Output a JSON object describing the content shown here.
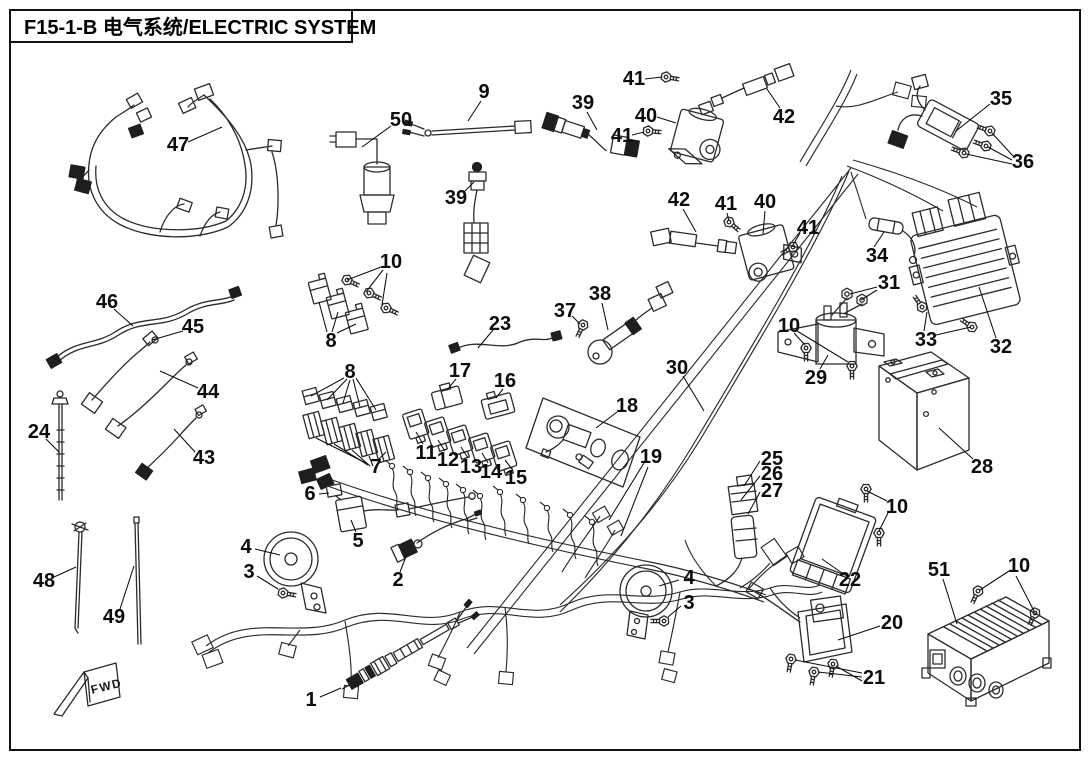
{
  "doc": {
    "title": "F15-1-B 电气系统/ELECTRIC SYSTEM",
    "fwd": "FWD"
  },
  "style": {
    "line_color": "#2b2b2b",
    "label_color": "#0d0d0d",
    "background": "#ffffff"
  },
  "callouts": [
    {
      "n": "47",
      "x": 178,
      "y": 145,
      "l": [
        [
          188,
          142,
          222,
          127
        ]
      ]
    },
    {
      "n": "50",
      "x": 401,
      "y": 120,
      "l": [
        [
          391,
          126,
          362,
          147
        ]
      ]
    },
    {
      "n": "9",
      "x": 484,
      "y": 92,
      "l": [
        [
          481,
          101,
          468,
          121
        ]
      ]
    },
    {
      "n": "39",
      "x": 583,
      "y": 103,
      "l": [
        [
          587,
          112,
          597,
          130
        ]
      ]
    },
    {
      "n": "41",
      "x": 634,
      "y": 79,
      "l": [
        [
          645,
          79,
          662,
          77
        ]
      ]
    },
    {
      "n": "40",
      "x": 646,
      "y": 116,
      "l": [
        [
          657,
          117,
          676,
          123
        ]
      ]
    },
    {
      "n": "41",
      "x": 622,
      "y": 136,
      "l": [
        [
          632,
          135,
          644,
          132
        ]
      ]
    },
    {
      "n": "42",
      "x": 784,
      "y": 117,
      "l": [
        [
          780,
          108,
          767,
          89
        ]
      ]
    },
    {
      "n": "35",
      "x": 1001,
      "y": 99,
      "l": [
        [
          990,
          104,
          956,
          131
        ]
      ]
    },
    {
      "n": "36",
      "x": 1023,
      "y": 162,
      "l": [
        [
          1013,
          156,
          992,
          133
        ],
        [
          1012,
          160,
          988,
          147
        ],
        [
          1012,
          164,
          966,
          154
        ]
      ]
    },
    {
      "n": "39",
      "x": 456,
      "y": 198,
      "l": [
        [
          464,
          192,
          474,
          182
        ]
      ]
    },
    {
      "n": "10",
      "x": 391,
      "y": 262,
      "l": [
        [
          381,
          267,
          347,
          280
        ],
        [
          383,
          270,
          366,
          292
        ],
        [
          387,
          273,
          382,
          305
        ]
      ]
    },
    {
      "n": "8",
      "x": 331,
      "y": 341,
      "l": [
        [
          327,
          332,
          319,
          302
        ],
        [
          332,
          332,
          338,
          312
        ],
        [
          337,
          333,
          356,
          324
        ]
      ]
    },
    {
      "n": "23",
      "x": 500,
      "y": 324,
      "l": [
        [
          493,
          330,
          478,
          348
        ]
      ]
    },
    {
      "n": "17",
      "x": 460,
      "y": 371,
      "l": [
        [
          456,
          379,
          447,
          390
        ]
      ]
    },
    {
      "n": "16",
      "x": 505,
      "y": 381,
      "l": [
        [
          503,
          389,
          496,
          398
        ]
      ]
    },
    {
      "n": "37",
      "x": 565,
      "y": 311,
      "l": [
        [
          572,
          316,
          580,
          324
        ]
      ]
    },
    {
      "n": "38",
      "x": 600,
      "y": 294,
      "l": [
        [
          602,
          303,
          608,
          330
        ]
      ]
    },
    {
      "n": "30",
      "x": 677,
      "y": 368,
      "l": [
        [
          683,
          376,
          704,
          411
        ]
      ]
    },
    {
      "n": "8",
      "x": 350,
      "y": 372,
      "l": [
        [
          344,
          378,
          311,
          396
        ],
        [
          347,
          379,
          327,
          400
        ],
        [
          350,
          380,
          343,
          403
        ],
        [
          353,
          379,
          360,
          407
        ],
        [
          356,
          378,
          376,
          410
        ]
      ]
    },
    {
      "n": "7",
      "x": 376,
      "y": 467,
      "l": [
        [
          366,
          463,
          316,
          438
        ],
        [
          368,
          465,
          334,
          444
        ],
        [
          370,
          466,
          352,
          450
        ],
        [
          373,
          466,
          369,
          456
        ],
        [
          378,
          460,
          386,
          452
        ]
      ]
    },
    {
      "n": "11",
      "x": 426,
      "y": 453,
      "l": [
        [
          423,
          444,
          416,
          432
        ]
      ]
    },
    {
      "n": "12",
      "x": 448,
      "y": 460,
      "l": [
        [
          445,
          451,
          438,
          440
        ]
      ]
    },
    {
      "n": "13",
      "x": 471,
      "y": 467,
      "l": [
        [
          468,
          458,
          461,
          447
        ]
      ]
    },
    {
      "n": "14",
      "x": 491,
      "y": 472,
      "l": [
        [
          488,
          463,
          482,
          453
        ]
      ]
    },
    {
      "n": "15",
      "x": 516,
      "y": 478,
      "l": [
        [
          512,
          469,
          505,
          460
        ]
      ]
    },
    {
      "n": "18",
      "x": 627,
      "y": 406,
      "l": [
        [
          617,
          412,
          596,
          428
        ]
      ]
    },
    {
      "n": "19",
      "x": 651,
      "y": 457,
      "l": [
        [
          644,
          463,
          609,
          520
        ],
        [
          648,
          467,
          621,
          536
        ]
      ]
    },
    {
      "n": "25",
      "x": 772,
      "y": 459,
      "l": [
        [
          760,
          461,
          744,
          486
        ]
      ]
    },
    {
      "n": "26",
      "x": 772,
      "y": 474,
      "l": [
        [
          760,
          476,
          741,
          500
        ]
      ]
    },
    {
      "n": "27",
      "x": 772,
      "y": 491,
      "l": [
        [
          760,
          492,
          748,
          514
        ]
      ]
    },
    {
      "n": "10",
      "x": 897,
      "y": 507,
      "l": [
        [
          887,
          501,
          867,
          491
        ],
        [
          888,
          513,
          879,
          531
        ]
      ]
    },
    {
      "n": "22",
      "x": 850,
      "y": 580,
      "l": [
        [
          842,
          573,
          822,
          559
        ]
      ]
    },
    {
      "n": "20",
      "x": 892,
      "y": 623,
      "l": [
        [
          880,
          626,
          838,
          640
        ]
      ]
    },
    {
      "n": "21",
      "x": 874,
      "y": 678,
      "l": [
        [
          862,
          673,
          795,
          660
        ],
        [
          862,
          677,
          818,
          672
        ],
        [
          862,
          681,
          836,
          666
        ]
      ]
    },
    {
      "n": "51",
      "x": 939,
      "y": 570,
      "l": [
        [
          943,
          579,
          957,
          624
        ]
      ]
    },
    {
      "n": "10",
      "x": 1019,
      "y": 566,
      "l": [
        [
          1009,
          571,
          980,
          590
        ],
        [
          1016,
          576,
          1034,
          611
        ]
      ]
    },
    {
      "n": "28",
      "x": 982,
      "y": 467,
      "l": [
        [
          973,
          459,
          939,
          428
        ]
      ]
    },
    {
      "n": "31",
      "x": 889,
      "y": 283,
      "l": [
        [
          877,
          287,
          850,
          294
        ],
        [
          877,
          290,
          861,
          300
        ]
      ]
    },
    {
      "n": "34",
      "x": 877,
      "y": 256,
      "l": [
        [
          874,
          247,
          884,
          232
        ]
      ]
    },
    {
      "n": "33",
      "x": 926,
      "y": 340,
      "l": [
        [
          924,
          331,
          927,
          312
        ],
        [
          936,
          335,
          971,
          327
        ]
      ]
    },
    {
      "n": "32",
      "x": 1001,
      "y": 347,
      "l": [
        [
          996,
          338,
          979,
          287
        ]
      ]
    },
    {
      "n": "29",
      "x": 816,
      "y": 378,
      "l": [
        [
          820,
          369,
          828,
          355
        ]
      ]
    },
    {
      "n": "10",
      "x": 789,
      "y": 326,
      "l": [
        [
          794,
          333,
          805,
          345
        ],
        [
          797,
          331,
          848,
          362
        ]
      ]
    },
    {
      "n": "42",
      "x": 679,
      "y": 200,
      "l": [
        [
          683,
          209,
          696,
          232
        ]
      ]
    },
    {
      "n": "41",
      "x": 726,
      "y": 204,
      "l": [
        [
          727,
          213,
          729,
          221
        ]
      ]
    },
    {
      "n": "40",
      "x": 765,
      "y": 202,
      "l": [
        [
          765,
          211,
          763,
          234
        ]
      ]
    },
    {
      "n": "41",
      "x": 808,
      "y": 228,
      "l": [
        [
          800,
          233,
          793,
          245
        ]
      ]
    },
    {
      "n": "46",
      "x": 107,
      "y": 302,
      "l": [
        [
          114,
          309,
          133,
          326
        ]
      ]
    },
    {
      "n": "45",
      "x": 193,
      "y": 327,
      "l": [
        [
          183,
          331,
          152,
          340
        ]
      ]
    },
    {
      "n": "44",
      "x": 208,
      "y": 392,
      "l": [
        [
          198,
          388,
          160,
          371
        ]
      ]
    },
    {
      "n": "43",
      "x": 204,
      "y": 458,
      "l": [
        [
          195,
          452,
          174,
          429
        ]
      ]
    },
    {
      "n": "24",
      "x": 39,
      "y": 432,
      "l": [
        [
          46,
          439,
          59,
          452
        ]
      ]
    },
    {
      "n": "48",
      "x": 44,
      "y": 581,
      "l": [
        [
          54,
          577,
          76,
          567
        ]
      ]
    },
    {
      "n": "49",
      "x": 114,
      "y": 617,
      "l": [
        [
          120,
          609,
          134,
          566
        ]
      ]
    },
    {
      "n": "4",
      "x": 246,
      "y": 547,
      "l": [
        [
          255,
          549,
          280,
          555
        ]
      ]
    },
    {
      "n": "3",
      "x": 249,
      "y": 572,
      "l": [
        [
          257,
          576,
          278,
          589
        ]
      ]
    },
    {
      "n": "5",
      "x": 358,
      "y": 541,
      "l": [
        [
          356,
          532,
          351,
          520
        ]
      ]
    },
    {
      "n": "6",
      "x": 310,
      "y": 494,
      "l": [
        [
          319,
          494,
          329,
          493
        ]
      ]
    },
    {
      "n": "2",
      "x": 398,
      "y": 580,
      "l": [
        [
          400,
          572,
          407,
          554
        ]
      ]
    },
    {
      "n": "4",
      "x": 689,
      "y": 578,
      "l": [
        [
          679,
          580,
          659,
          586
        ]
      ]
    },
    {
      "n": "3",
      "x": 689,
      "y": 603,
      "l": [
        [
          681,
          606,
          668,
          617
        ]
      ]
    },
    {
      "n": "1",
      "x": 311,
      "y": 700,
      "l": [
        [
          320,
          697,
          341,
          688
        ]
      ]
    }
  ]
}
